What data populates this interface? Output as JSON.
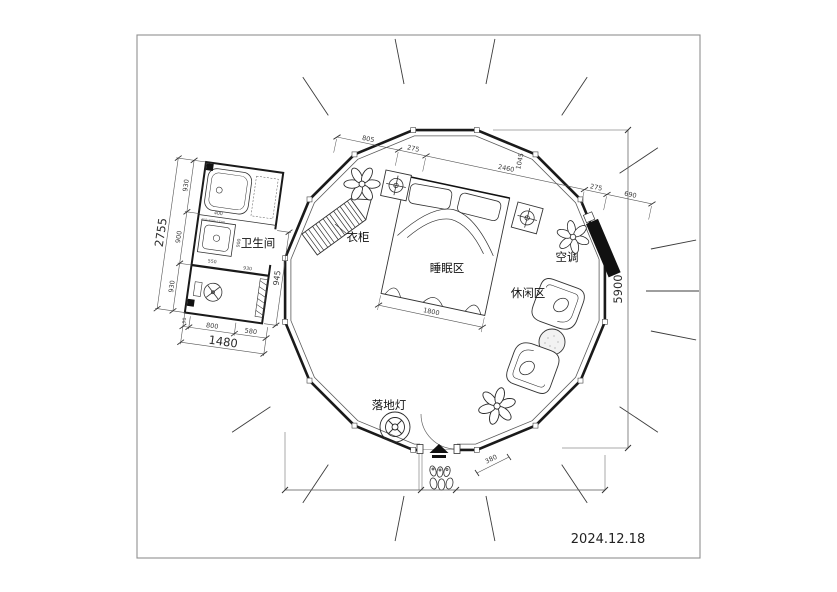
{
  "frame": {
    "date": "2024.12.18"
  },
  "rooms": {
    "bathroom": "卫生间",
    "wardrobe": "衣柜",
    "sleeping_area": "睡眠区",
    "leisure_area": "休闲区",
    "air_conditioner": "空调",
    "floor_lamp": "落地灯"
  },
  "dims": {
    "top": [
      "805",
      "275",
      "2460",
      "1045",
      "275",
      "690"
    ],
    "bed_width": "1800",
    "overall_height": "5900",
    "entry_offset": "380",
    "bath_left": [
      "930",
      "900",
      "930"
    ],
    "bath_left_total": "2755",
    "bath_bottom": [
      "90",
      "800",
      "580"
    ],
    "bath_bottom_total": "1480",
    "bath_right": "945",
    "bath_sink": "550",
    "bath_inner_h": "900",
    "bath_inner_w": "930",
    "bath_tub": "400",
    "bath_note": "450x600x1500"
  },
  "colors": {
    "wall": "#1a1a1a",
    "dim_line": "#555",
    "ac_fill": "#111"
  }
}
